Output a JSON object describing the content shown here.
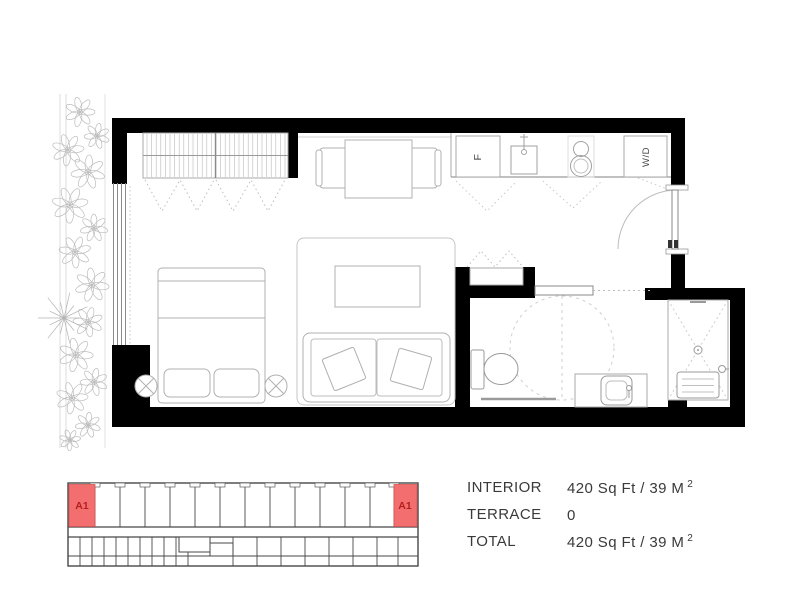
{
  "floor_plan": {
    "labels": {
      "fridge": "F",
      "washer_dryer": "W/D"
    }
  },
  "key_plan": {
    "left_unit_label": "A1",
    "right_unit_label": "A1",
    "highlight_fill": "#f36e6e",
    "label_color": "#b5201f"
  },
  "stats": {
    "rows": [
      {
        "label": "INTERIOR",
        "value": "420 Sq Ft / 39 M",
        "sup": "2"
      },
      {
        "label": "TERRACE",
        "value": "0",
        "sup": ""
      },
      {
        "label": "TOTAL",
        "value": "420 Sq Ft / 39 M",
        "sup": "2"
      }
    ]
  },
  "colors": {
    "walls": "#000000",
    "furniture_line": "#b0b0b0",
    "text": "#3a3a3a"
  }
}
